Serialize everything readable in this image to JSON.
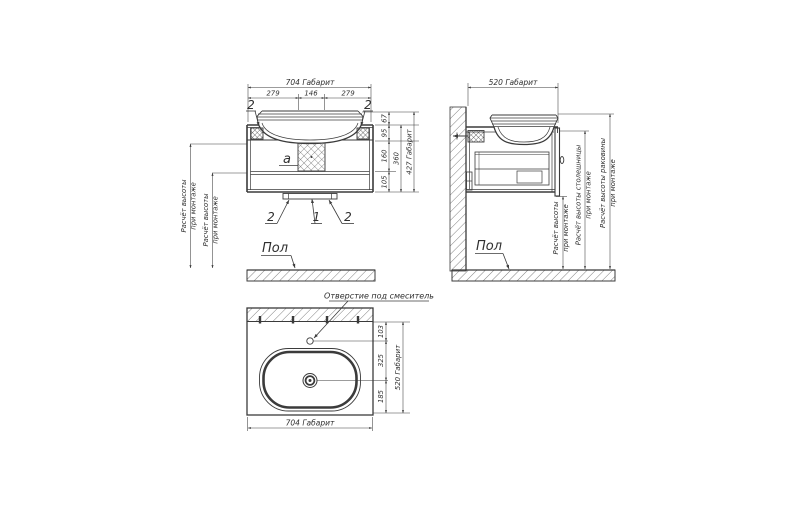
{
  "front_view": {
    "dims": {
      "overall_width": "704 Габарит",
      "width_left": "279",
      "width_center": "146",
      "width_right": "279",
      "h_sink": "67",
      "h_top": "95",
      "h_mid": "160",
      "h_bottom": "105",
      "h_body": "360",
      "overall_height": "427 Габарит"
    },
    "callouts": {
      "top_left": "2",
      "top_right": "2",
      "bottom_left": "2",
      "bottom_center": "1",
      "bottom_right": "2",
      "detail_a": "а"
    },
    "install_height_1": {
      "line1": "Расчёт высоты",
      "line2": "при монтаже"
    },
    "install_height_2": {
      "line1": "Расчёт высоты",
      "line2": "при монтаже"
    },
    "floor_label": "Пол"
  },
  "side_view": {
    "dims": {
      "overall_depth": "520 Габарит"
    },
    "install_height": {
      "line1": "Расчёт высоты",
      "line2": "при монтаже"
    },
    "countertop_height": {
      "line1": "Расчёт высоты столешницы",
      "line2": "при монтаже"
    },
    "sink_height": {
      "line1": "Расчёт высоты раковины",
      "line2": "при монтаже"
    },
    "floor_label": "Пол"
  },
  "top_view": {
    "faucet_hole_label": "Отверстие под смеситель",
    "dims": {
      "to_faucet": "103",
      "faucet_to_drain": "325",
      "drain_to_front": "185",
      "overall_depth": "520 Габарит",
      "overall_width": "704 Габарит"
    }
  }
}
